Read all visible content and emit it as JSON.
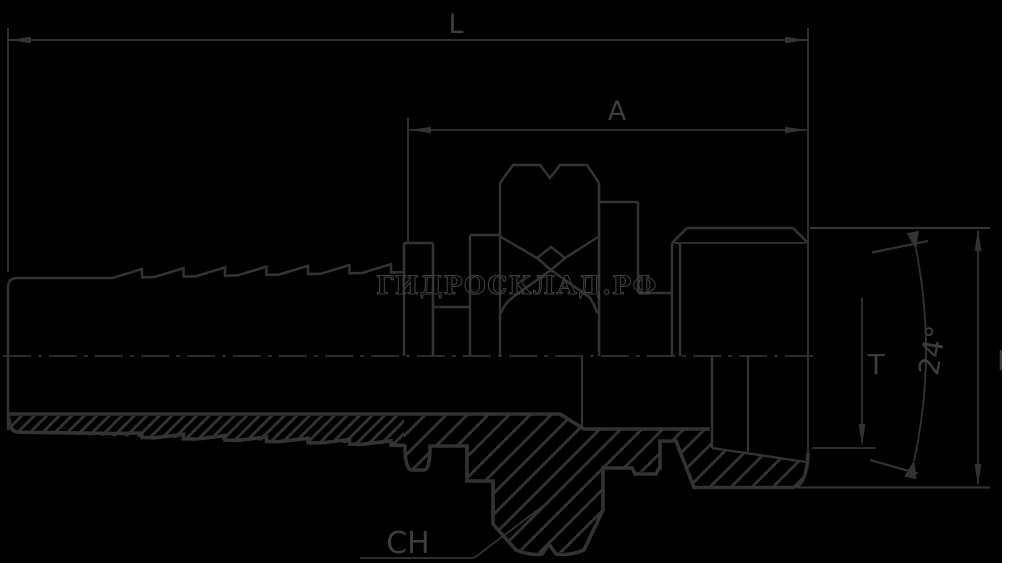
{
  "drawing": {
    "type": "hydraulic-fitting-technical-drawing",
    "watermark": "ГИДРОСКЛАД.РФ",
    "dimension_labels": {
      "overall_length": "L",
      "thread_section_length": "A",
      "cone_depth": "T",
      "cone_angle": "24°",
      "end_diameter": "F",
      "hex_size": "CH"
    },
    "colors": {
      "background": "#000000",
      "line": "#333333",
      "label": "#3d3d3d",
      "watermark": "#3f3f3f",
      "right_margin": "#ffffff"
    }
  }
}
